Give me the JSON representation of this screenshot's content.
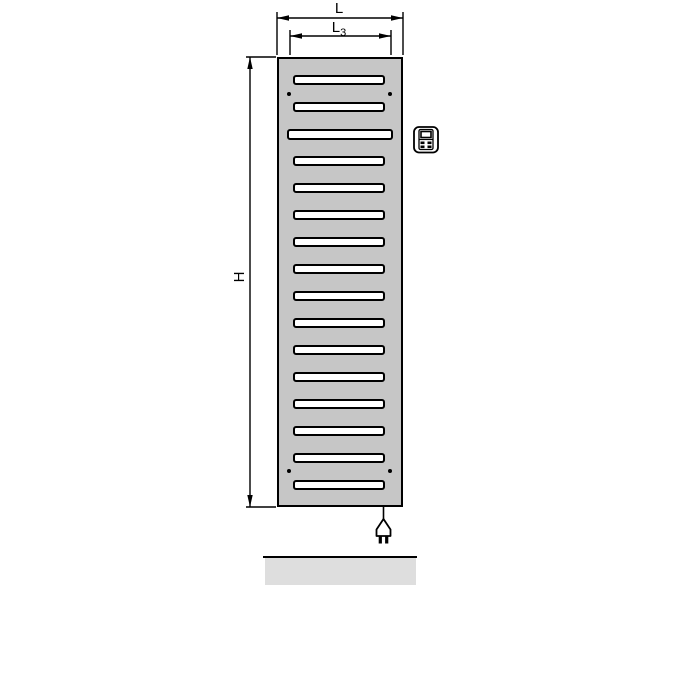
{
  "diagram": {
    "labels": {
      "width": "L",
      "inner_width_base": "L",
      "inner_width_sub": "3",
      "height": "H"
    },
    "radiator": {
      "slot_count": 16,
      "wide_slot_index": 2,
      "mounting_dot_pairs": 2
    },
    "icons": {
      "control": "control-unit-icon",
      "plug": "power-plug-icon"
    },
    "colors": {
      "panel": "#c6c6c6",
      "slot": "#ffffff",
      "line": "#000000",
      "floor": "#dedede"
    }
  }
}
